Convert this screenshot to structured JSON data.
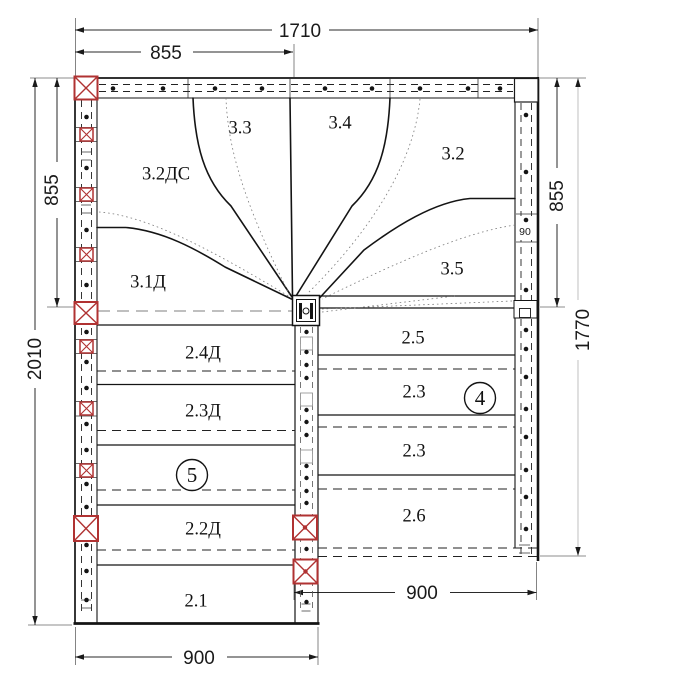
{
  "dimensions": {
    "total_width": "1710",
    "half_width": "855",
    "left_upper": "855",
    "left_total": "2010",
    "right_upper": "855",
    "right_total": "1770",
    "stud": "90",
    "bottom_left": "900",
    "bottom_right": "900"
  },
  "winders": {
    "w33": "3.3",
    "w34": "3.4",
    "w32": "3.2",
    "w32dc": "3.2ДС",
    "w31d": "3.1Д",
    "w35": "3.5"
  },
  "left_flight": {
    "t1": "2.4Д",
    "t2": "2.3Д",
    "t3": "2.2Д",
    "t4": "2.1",
    "marker": "5"
  },
  "right_flight": {
    "t1": "2.5",
    "t2": "2.3",
    "t3": "2.3",
    "t4": "2.6",
    "marker": "4"
  }
}
